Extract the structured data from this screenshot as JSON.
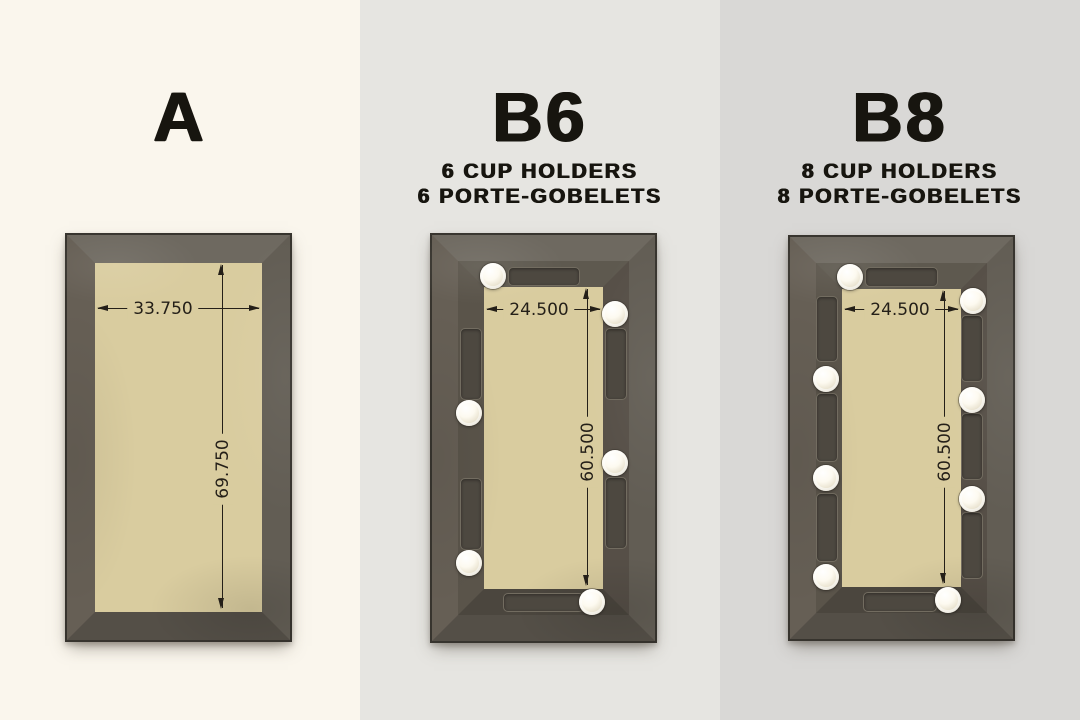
{
  "colors": {
    "bg_a": "#faf6ed",
    "bg_b6": "#e6e5e1",
    "bg_b8": "#d9d8d6",
    "title_ink": "#17150f",
    "ink": "#241f18",
    "outline": "#37342e",
    "frame_top": "#6e6960",
    "frame_right": "#625d54",
    "frame_bottom": "#544f47",
    "frame_left": "#665f55",
    "rail_top": "#5e594f",
    "rail_right": "#564f47",
    "rail_bottom": "#4b463e",
    "rail_left": "#5a544a",
    "tray": "#4d4840",
    "felt": "#d9cc9f",
    "cup_holder": "#f6f1e2"
  },
  "panels": [
    {
      "id": "A",
      "title": "A",
      "subtitles": [],
      "cup_holder_count": 0,
      "dimensions": {
        "width": "33.750",
        "height": "69.750"
      }
    },
    {
      "id": "B6",
      "title": "B6",
      "subtitles": [
        "6 CUP HOLDERS",
        "6 PORTE-GOBELETS"
      ],
      "cup_holder_count": 6,
      "dimensions": {
        "width": "24.500",
        "height": "60.500"
      }
    },
    {
      "id": "B8",
      "title": "B8",
      "subtitles": [
        "8 CUP HOLDERS",
        "8 PORTE-GOBELETS"
      ],
      "cup_holder_count": 8,
      "dimensions": {
        "width": "24.500",
        "height": "60.500"
      }
    }
  ]
}
